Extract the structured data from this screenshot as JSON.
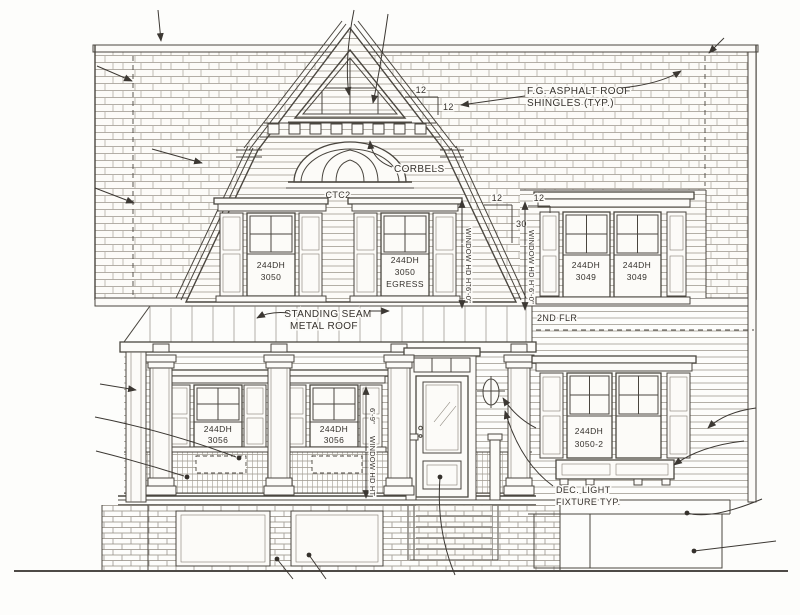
{
  "drawing": {
    "paper_color": "#fcfbf8",
    "ink_color": "#4a463f",
    "annotations": {
      "roof": {
        "line1": "F.G. ASPHALT ROOF",
        "line2": "SHINGLES (TYP.)"
      },
      "corbels": "CORBELS",
      "arch_tag": "CTC2",
      "standing_seam": {
        "line1": "STANDING SEAM",
        "line2": "METAL ROOF"
      },
      "second_floor": "2ND FLR",
      "dec_light": {
        "line1": "DEC. LIGHT",
        "line2": "FIXTURE TYP."
      }
    },
    "pitch": {
      "upper_run": "12",
      "upper_rise": "12",
      "lower_run": "12",
      "lower_rise": "30",
      "dormer": "12"
    },
    "dimensions": {
      "gable": {
        "label": "WINDOW HD HT",
        "value": "6'-0\""
      },
      "dormer": {
        "label": "WINDOW HD HT",
        "value": "6'-0\""
      },
      "first_floor": {
        "label": "WINDOW HD HT",
        "value": "6'-9\""
      }
    },
    "windows": {
      "gable_left": {
        "line1": "244DH",
        "line2": "3050"
      },
      "gable_right": {
        "line1": "244DH",
        "line2": "3050",
        "line3": "EGRESS"
      },
      "dormer_left": {
        "line1": "244DH",
        "line2": "3049"
      },
      "dormer_right": {
        "line1": "244DH",
        "line2": "3049"
      },
      "porch_left": {
        "line1": "244DH",
        "line2": "3056"
      },
      "porch_center": {
        "line1": "244DH",
        "line2": "3056"
      },
      "wing_first": {
        "line1": "244DH",
        "line2": "3050-2"
      }
    }
  }
}
